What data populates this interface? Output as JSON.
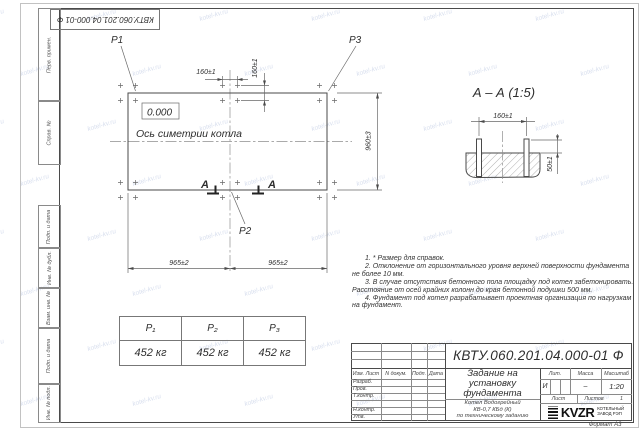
{
  "watermark": "kotel-kv.ru",
  "stamp_top": "КВТУ.060.201.04.000-01 Ф",
  "frame_labels": [
    "Перв. примен.",
    "Справ. №",
    "Подп. и дата",
    "Инв. № дубл.",
    "Взам. инв. №",
    "Подп. и дата",
    "Инв. № подл."
  ],
  "plan": {
    "elevation": "0.000",
    "axis_label": "Ось симетрии котла",
    "load_p1": "P1",
    "load_p2": "P2",
    "load_p3": "P3",
    "section_letter": "А",
    "dims": {
      "bolt_x": "160±1",
      "bolt_y": "160±1",
      "span_left": "965±2",
      "span_right": "965±2",
      "depth": "960±3"
    }
  },
  "section": {
    "title": "А – А (1:5)",
    "dim_spacing": "160±1",
    "dim_height": "50±1"
  },
  "load_table": {
    "headers": [
      "P₁",
      "P₂",
      "P₃"
    ],
    "values": [
      "452 кг",
      "452 кг",
      "452 кг"
    ]
  },
  "notes": [
    "1. * Размер для справок.",
    "2. Отклонение от горизонтального уровня верхней поверхности фундамента не более 10 мм.",
    "3. В случае отсутствия бетонного пола площадку под котел забетонировать. Расстояние от осей крайних колонн до края бетонной подушки 500 мм.",
    "4. Фундамент под котел разрабатывает проектная организация по нагрузкам на фундамент."
  ],
  "title_block": {
    "doc_number": "КВТУ.060.201.04.000-01 Ф",
    "title_lines": [
      "Задание на",
      "установку",
      "фундамента"
    ],
    "product_lines": [
      "Котел Водогрейный",
      "КВ-0,7 КБд (К)",
      "по техническому заданию"
    ],
    "col_izm": "Изм. Лист",
    "col_doc": "N докум.",
    "col_sign": "Подп.",
    "col_date": "Дата",
    "rows": [
      "Разраб.",
      "Пров.",
      "Т.контр.",
      "",
      "Н.контр.",
      "Утв."
    ],
    "lit_label": "Лит.",
    "lit_value": "И",
    "mass_label": "Масса",
    "mass_value": "–",
    "scale_label": "Масштаб",
    "scale_value": "1:20",
    "sheet_label": "Лист",
    "sheets_label": "Листов",
    "sheets_value": "1",
    "logo_text": "KVZR",
    "logo_sub1": "КОТЕЛЬНЫЙ",
    "logo_sub2": "ЗАВОД РЭП",
    "format_note": "Формат А3"
  }
}
